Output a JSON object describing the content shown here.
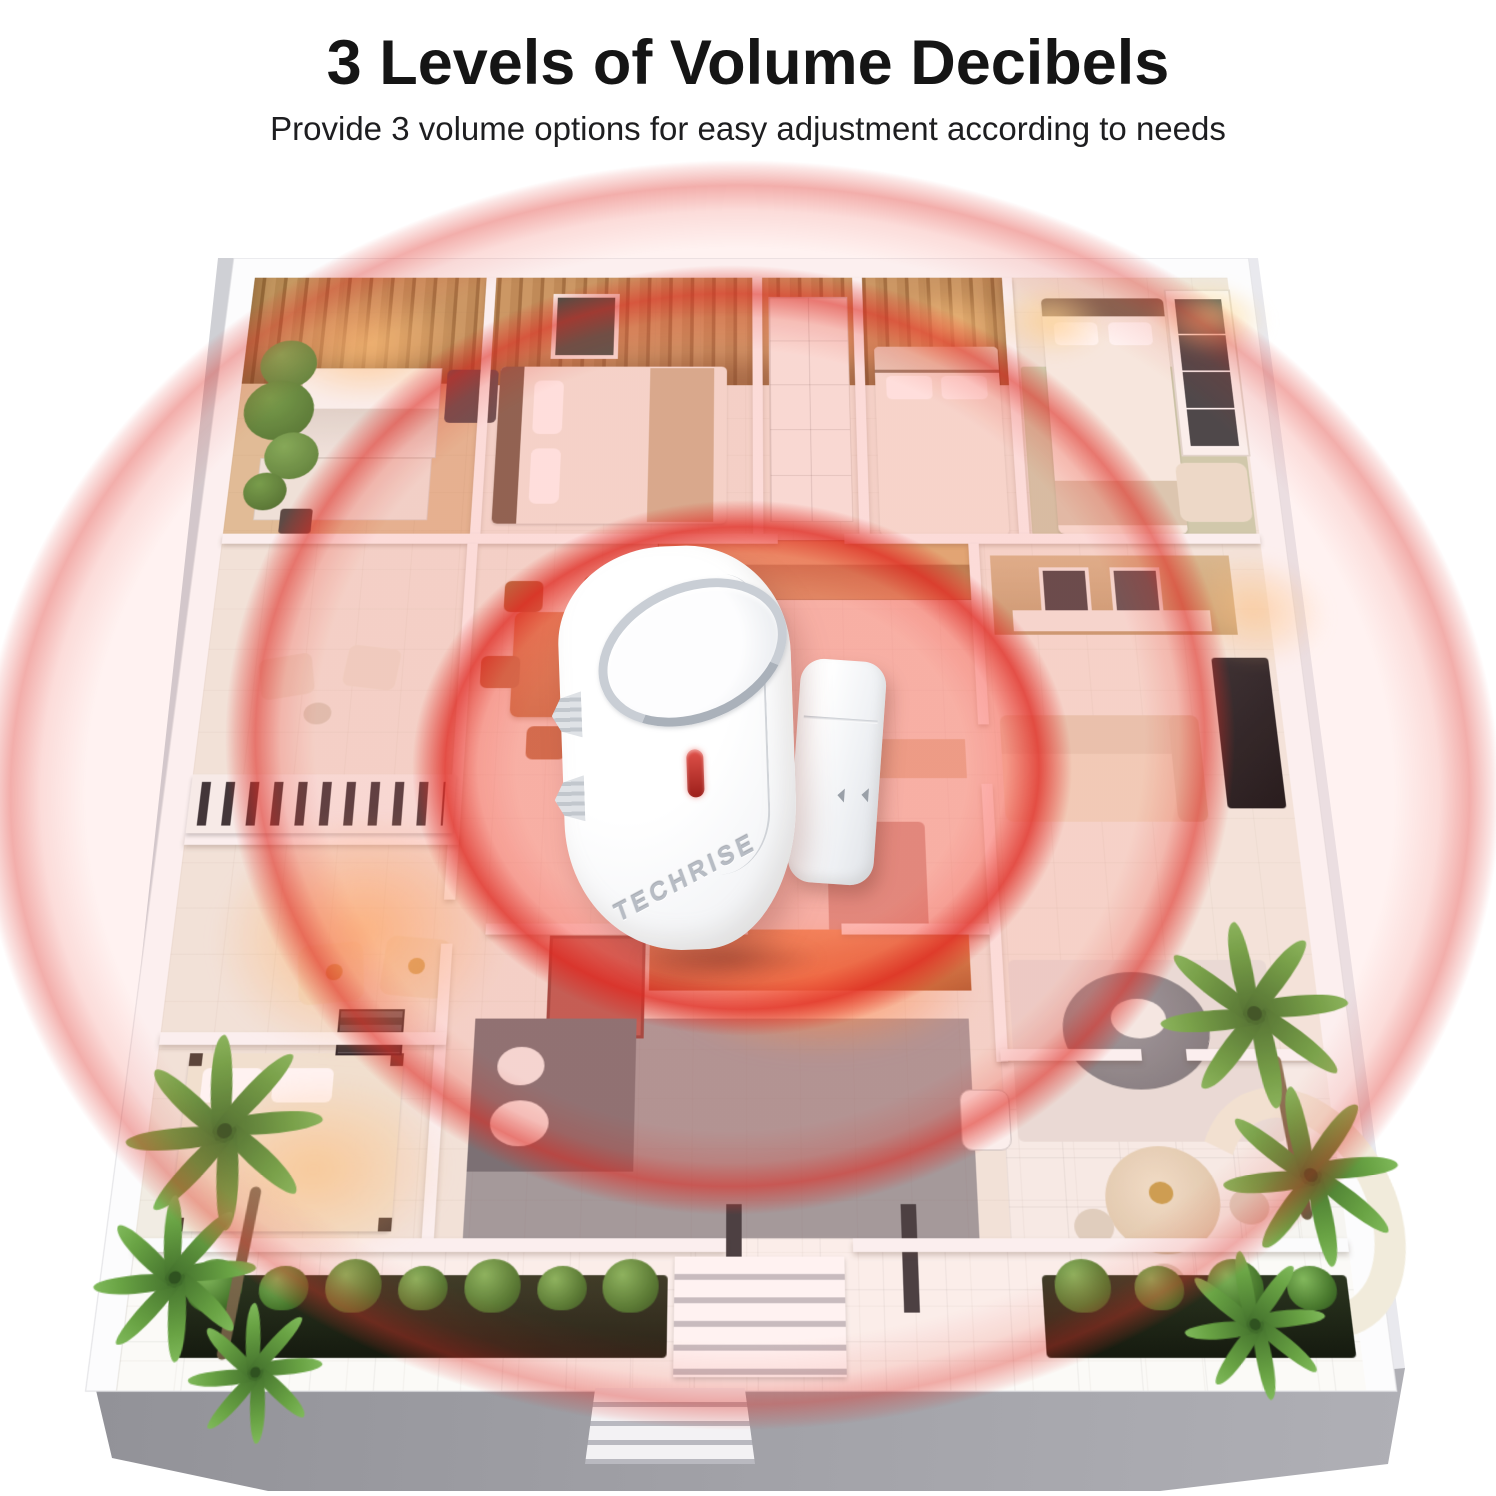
{
  "header": {
    "title": "3 Levels of Volume Decibels",
    "subtitle": "Provide 3 volume options for easy adjustment according to needs"
  },
  "device": {
    "brand": "TECHRISE",
    "body_color": "#ffffff",
    "led_color": "#c0392b"
  },
  "coverage": {
    "levels": 3,
    "ring_color": "#e23c32"
  },
  "scene": {
    "background": "#ffffff"
  }
}
